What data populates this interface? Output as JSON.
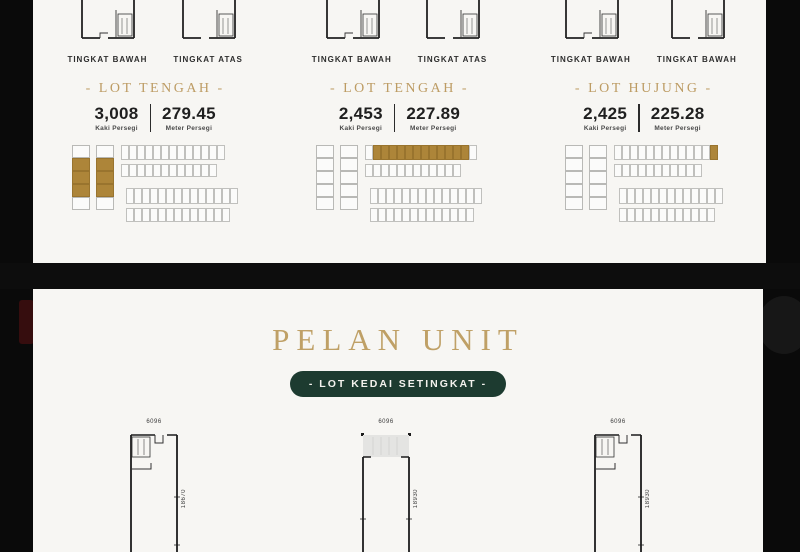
{
  "panels": {
    "top": {
      "sections": [
        {
          "floor_labels": [
            "TINGKAT BAWAH",
            "TINGKAT ATAS"
          ],
          "lot_title": "- LOT TENGAH -",
          "area_sqft": "3,008",
          "area_sqft_unit": "Kaki Persegi",
          "area_sqm": "279.45",
          "area_sqm_unit": "Meter Persegi",
          "sitemap": {
            "strips": [
              {
                "count": 5,
                "gold": [
                  1,
                  2,
                  3
                ]
              },
              {
                "count": 5,
                "gold": [
                  1,
                  2,
                  3
                ]
              }
            ],
            "rows": [
              {
                "count": 13,
                "gold": []
              },
              {
                "count": 12,
                "gold": []
              },
              {
                "count": 14,
                "gold": []
              },
              {
                "count": 13,
                "gold": []
              }
            ]
          }
        },
        {
          "floor_labels": [
            "TINGKAT BAWAH",
            "TINGKAT ATAS"
          ],
          "lot_title": "- LOT TENGAH -",
          "area_sqft": "2,453",
          "area_sqft_unit": "Kaki Persegi",
          "area_sqm": "227.89",
          "area_sqm_unit": "Meter Persegi",
          "sitemap": {
            "strips": [
              {
                "count": 5,
                "gold": []
              },
              {
                "count": 5,
                "gold": []
              }
            ],
            "rows": [
              {
                "count": 14,
                "gold": [
                  1,
                  2,
                  3,
                  4,
                  5,
                  6,
                  7,
                  8,
                  9,
                  10,
                  11,
                  12
                ]
              },
              {
                "count": 12,
                "gold": []
              },
              {
                "count": 14,
                "gold": []
              },
              {
                "count": 13,
                "gold": []
              }
            ]
          }
        },
        {
          "floor_labels": [
            "TINGKAT BAWAH",
            "TINGKAT BAWAH"
          ],
          "lot_title": "- LOT HUJUNG -",
          "area_sqft": "2,425",
          "area_sqft_unit": "Kaki Persegi",
          "area_sqm": "225.28",
          "area_sqm_unit": "Meter Persegi",
          "sitemap": {
            "strips": [
              {
                "count": 5,
                "gold": []
              },
              {
                "count": 5,
                "gold": []
              }
            ],
            "rows": [
              {
                "count": 13,
                "gold": [
                  12
                ]
              },
              {
                "count": 11,
                "gold": []
              },
              {
                "count": 13,
                "gold": []
              },
              {
                "count": 12,
                "gold": []
              }
            ]
          }
        }
      ]
    },
    "bottom": {
      "title": "PELAN UNIT",
      "button_label": "- LOT KEDAI SETINGKAT -",
      "plans": [
        {
          "width_dim": "6096",
          "height_dim": "18670"
        },
        {
          "width_dim": "6096",
          "height_dim": "18930"
        },
        {
          "width_dim": "6096",
          "height_dim": "18930"
        }
      ]
    }
  },
  "colors": {
    "gold_fill": "#ad8539",
    "gold_text": "#bd9c64",
    "green_button": "#1d3b30",
    "panel_bg": "#f7f6f3",
    "page_bg": "#0a0a0a"
  }
}
